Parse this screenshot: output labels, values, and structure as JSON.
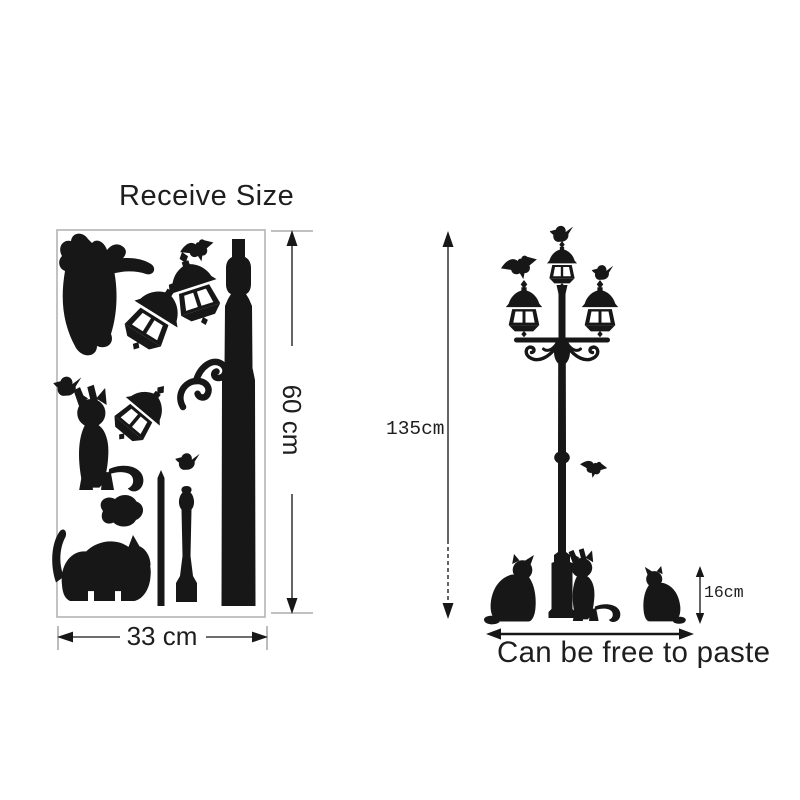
{
  "colors": {
    "ink": "#171717",
    "dimension_line": "#3d3d3d",
    "tick": "#ababab",
    "sheet_border": "#b4b4b4",
    "background": "#ffffff",
    "text": "#1e1e1e"
  },
  "left_panel": {
    "title": "Receive Size",
    "sheet": {
      "height_label": "60 cm",
      "width_label": "33 cm",
      "pieces": [
        "stretching-cat",
        "flying-bird",
        "street-lantern",
        "street-lantern",
        "street-lantern",
        "lamp-pole-segment",
        "scroll-ornament",
        "standing-cat",
        "perched-bird",
        "perched-bird",
        "cat-head",
        "walking-cat",
        "thin-rod",
        "baluster-post"
      ]
    }
  },
  "right_panel": {
    "lamp_height_label": "135cm",
    "cat_height_label": "16cm",
    "caption": "Can be free to paste",
    "figures": [
      "street-lamp-three-lanterns",
      "perched-bird",
      "flying-bird",
      "perched-bird",
      "flying-bird",
      "sitting-cat",
      "standing-cat",
      "sitting-cat"
    ]
  }
}
